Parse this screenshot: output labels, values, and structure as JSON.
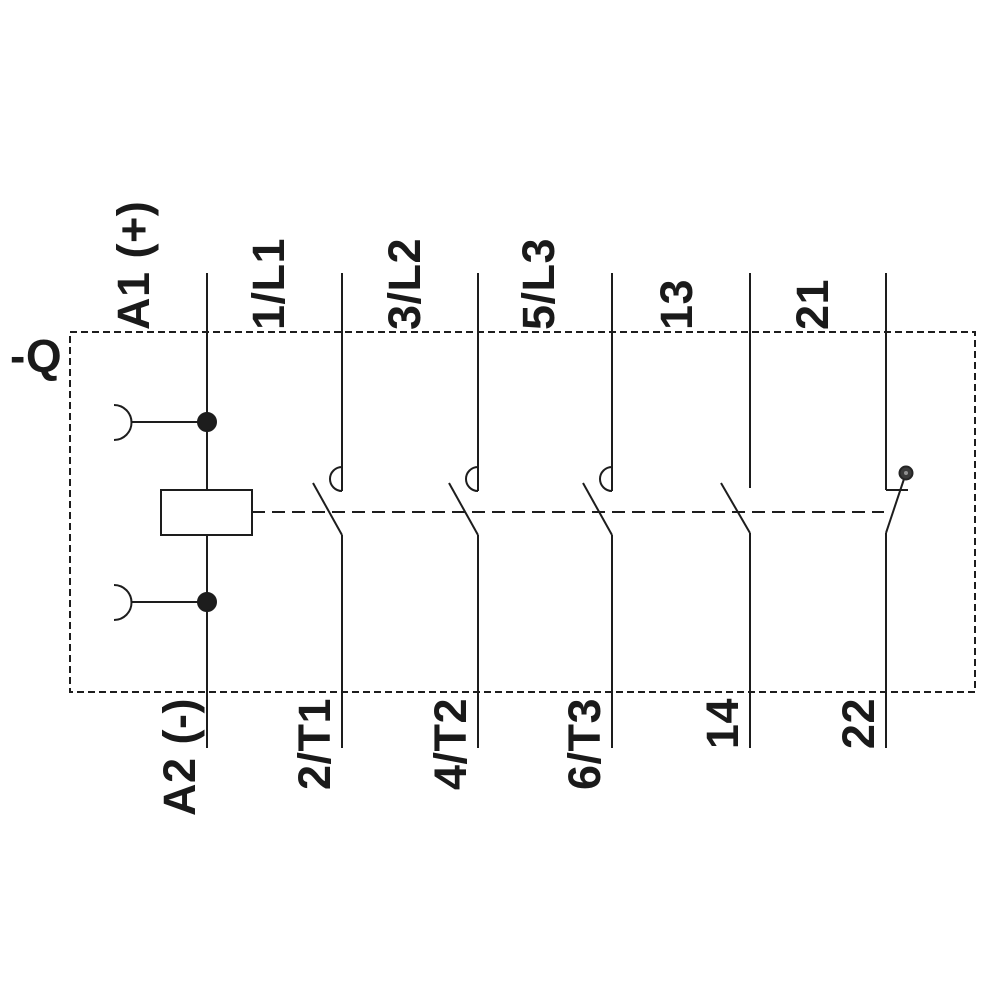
{
  "schematic": {
    "device_designation": "-Q",
    "coil": {
      "top_terminal": "A1 (+)",
      "bottom_terminal": "A2 (-)"
    },
    "poles": [
      {
        "top": "1/L1",
        "bottom": "2/T1",
        "contact_kind": "NO-main"
      },
      {
        "top": "3/L2",
        "bottom": "4/T2",
        "contact_kind": "NO-main"
      },
      {
        "top": "5/L3",
        "bottom": "6/T3",
        "contact_kind": "NO-main"
      },
      {
        "top": "13",
        "bottom": "14",
        "contact_kind": "NO-auxiliary"
      },
      {
        "top": "21",
        "bottom": "22",
        "contact_kind": "NC-auxiliary"
      }
    ],
    "colors": {
      "line": "#1d1d1d",
      "background": "#ffffff",
      "nc_contact_dot": "#3a3a3a",
      "nc_contact_dot_center": "#909090"
    }
  }
}
